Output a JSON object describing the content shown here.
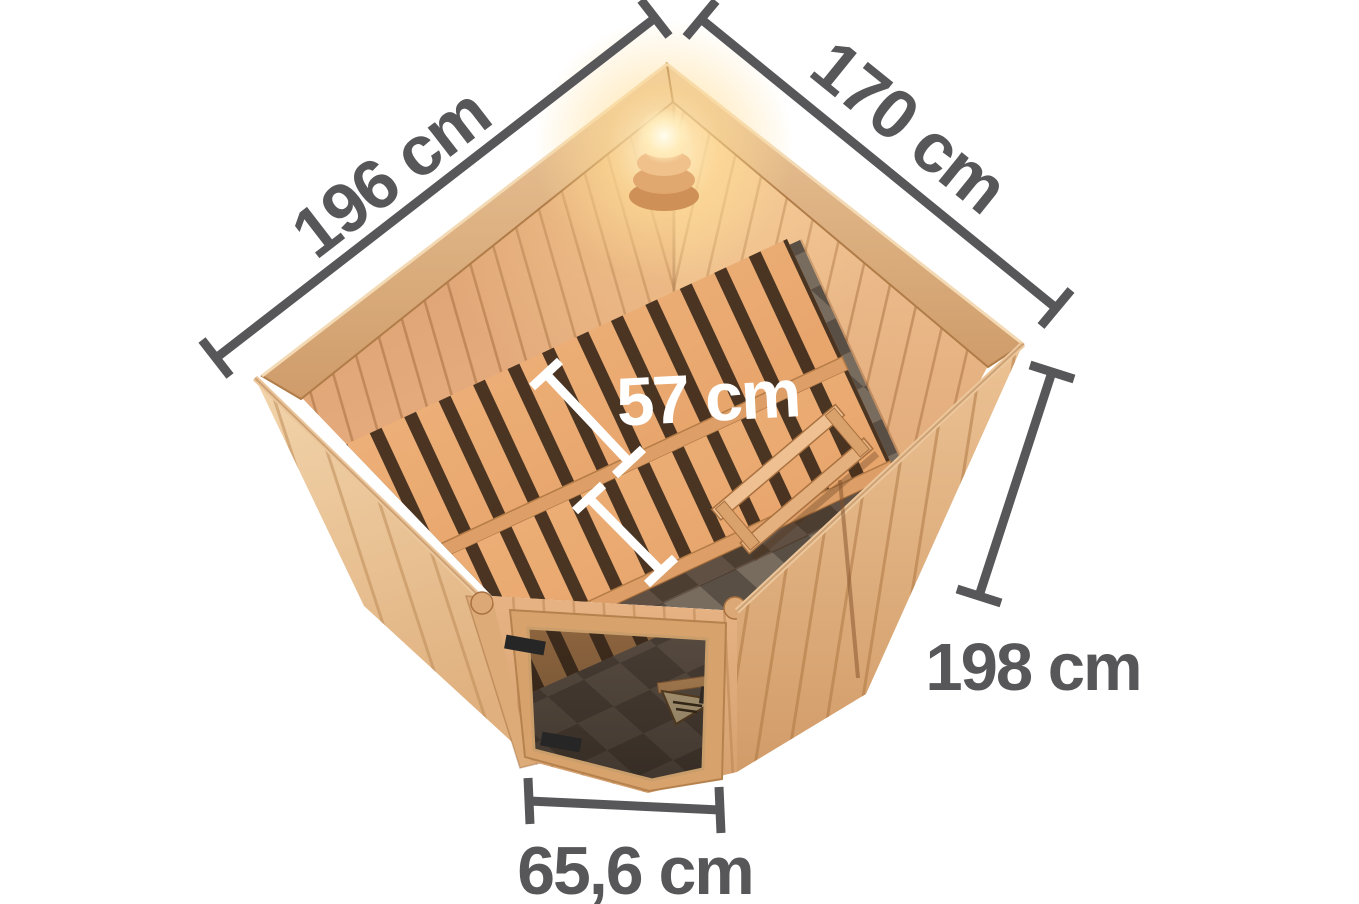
{
  "figure": {
    "type": "product-dimension-diagram",
    "subject": "corner sauna top view with interior benches, corner light and glass door"
  },
  "dimensions": {
    "back_left_wall": {
      "label": "196 cm"
    },
    "back_right_wall": {
      "label": "170 cm"
    },
    "bench_depth": {
      "label": "57 cm"
    },
    "wall_height": {
      "label": "198 cm"
    },
    "door_width": {
      "label": "65,6 cm"
    }
  },
  "colors": {
    "dimension_line": "#57575a",
    "bench_label": "#ffffff",
    "background": "#ffffff",
    "wood_light": "#eecaa1",
    "wood_mid": "#e2ab7d",
    "wood_dark": "#b5824e"
  }
}
